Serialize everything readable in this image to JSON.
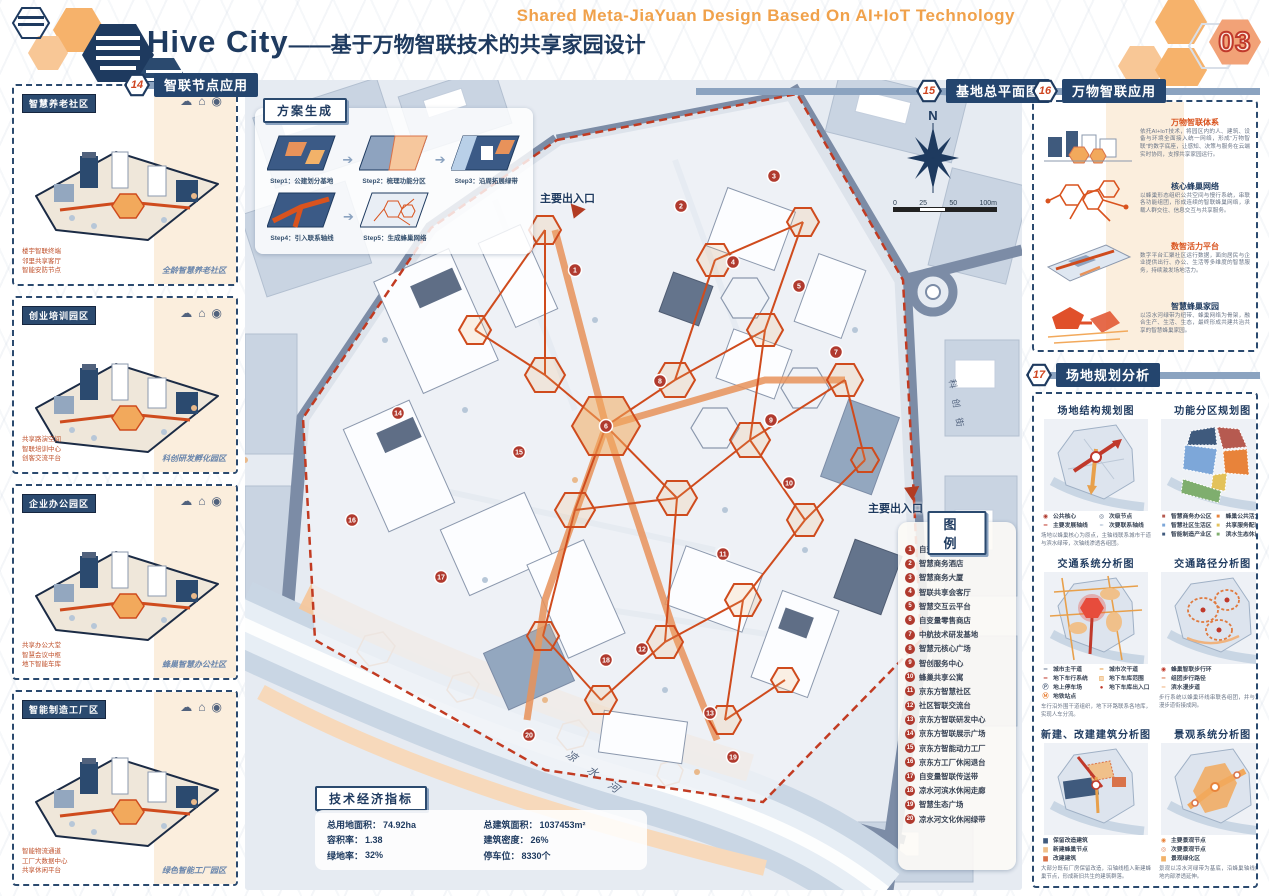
{
  "page": {
    "number": "03"
  },
  "colors": {
    "navy": "#1e3a5f",
    "orange": "#f0a14b",
    "accent_red": "#cf4520",
    "peach": "#f2a277",
    "panel_cream": "#fbeedd"
  },
  "header": {
    "subtitle_en": "Shared Meta-JiaYuan Design Based On AI+IoT Technology",
    "title_en": "· Hive City",
    "title_cn": "——基于万物智联技术的共享家园设计"
  },
  "sections": {
    "s14": {
      "tag": "14",
      "title": "智联节点应用"
    },
    "s15": {
      "tag": "15",
      "title": "基地总平面图"
    },
    "s16": {
      "tag": "16",
      "title": "万物智联应用"
    },
    "s17": {
      "tag": "17",
      "title": "场地规划分析"
    }
  },
  "left_panels": [
    {
      "label": "智慧养老社区",
      "caption": "全龄智慧养老社区",
      "callouts": [
        "楼宇智联终端",
        "邻里共享客厅",
        "智能安防节点"
      ]
    },
    {
      "label": "创业培训园区",
      "caption": "科创研发孵化园区",
      "callouts": [
        "共享路演空间",
        "智联培训中心",
        "创客交流平台"
      ]
    },
    {
      "label": "企业办公园区",
      "caption": "蜂巢智慧办公社区",
      "callouts": [
        "共享办公大堂",
        "智慧会议中枢",
        "地下智能车库"
      ]
    },
    {
      "label": "智能制造工厂区",
      "caption": "绿色智能工厂园区",
      "callouts": [
        "智能物流通道",
        "工厂大数据中心",
        "共享休闲平台"
      ]
    }
  ],
  "scheme": {
    "title": "方案生成",
    "steps": [
      "Step1：公建划分基地",
      "Step2：梳理功能分区",
      "Step3：沿周拓展绿带",
      "Step4：引入联系轴线",
      "Step5：生成蜂巢网络"
    ]
  },
  "map": {
    "north": "N",
    "scale_ticks": [
      "0",
      "25",
      "50",
      "100m"
    ],
    "entrance_top": "主要出入口",
    "entrance_right": "主要出入口",
    "river": "凉 水 河",
    "road": "科 创 街"
  },
  "legend": {
    "title": "图例",
    "items": [
      {
        "n": "1",
        "label": "自变量研发基地"
      },
      {
        "n": "2",
        "label": "智慧商务酒店"
      },
      {
        "n": "3",
        "label": "智慧商务大厦"
      },
      {
        "n": "4",
        "label": "智联共享会客厅"
      },
      {
        "n": "5",
        "label": "智慧交互云平台"
      },
      {
        "n": "6",
        "label": "自变量零售商店"
      },
      {
        "n": "7",
        "label": "中航技术研发基地"
      },
      {
        "n": "8",
        "label": "智慧元核心广场"
      },
      {
        "n": "9",
        "label": "智创服务中心"
      },
      {
        "n": "10",
        "label": "蜂巢共享公寓"
      },
      {
        "n": "11",
        "label": "京东方智慧社区"
      },
      {
        "n": "12",
        "label": "社区智联交流台"
      },
      {
        "n": "13",
        "label": "京东方智联研发中心"
      },
      {
        "n": "14",
        "label": "京东方智联展示广场"
      },
      {
        "n": "15",
        "label": "京东方智能动力工厂"
      },
      {
        "n": "16",
        "label": "京东方工厂休闲退台"
      },
      {
        "n": "17",
        "label": "自变量智联传送带"
      },
      {
        "n": "18",
        "label": "凉水河滨水休闲走廊"
      },
      {
        "n": "19",
        "label": "智慧生态广场"
      },
      {
        "n": "20",
        "label": "凉水河文化休闲绿带"
      }
    ]
  },
  "indicators": {
    "title": "技术经济指标",
    "rows": [
      {
        "label": "总用地面积：",
        "value": "74.92ha"
      },
      {
        "label": "容积率：",
        "value": "1.38"
      },
      {
        "label": "绿地率：",
        "value": "32%"
      },
      {
        "label": "总建筑面积：",
        "value": "1037453m²"
      },
      {
        "label": "建筑密度：",
        "value": "26%"
      },
      {
        "label": "停车位：",
        "value": "8330个"
      }
    ]
  },
  "iot": {
    "blocks": [
      {
        "title": "万物智联体系",
        "text": "依托AI+IoT技术，将园区内的人、建筑、设备与环境全面接入统一网络，形成“万物智联”的数字底座，让感知、决策与服务在云端实时协同，支撑共享家园运行。"
      },
      {
        "title": "核心蜂巢网络",
        "text": "以蜂巢形态组织公共空间与慢行系统，串联各功能组团，形成连续的智联蜂巢网络，承载人群交往、信息交互与共享服务。"
      },
      {
        "title": "数智活力平台",
        "text": "数字平台汇聚社区运行数据，面向居民与企业提供出行、办公、生活等多维度的智慧服务，持续激发场地活力。"
      },
      {
        "title": "智慧蜂巢家园",
        "text": "以凉水河绿带为纽带、蜂巢网络为骨架，融合生产、生活、生态，最终形成共建共治共享的智慧蜂巢家园。"
      }
    ]
  },
  "analysis": {
    "maps": [
      {
        "title": "场地结构规划图",
        "legend": [
          {
            "s": "◉",
            "c": "#b03a2e",
            "label": "公共核心"
          },
          {
            "s": "◎",
            "c": "#51627d",
            "label": "次级节点"
          },
          {
            "s": "━",
            "c": "#c0392b",
            "label": "主要发展轴线"
          },
          {
            "s": "┅",
            "c": "#8ba3c0",
            "label": "次要联系轴线"
          }
        ],
        "note": "场地以蜂巢核心为原点，主轴线联系城市干道与滨水绿带，次轴线渗透各组团。"
      },
      {
        "title": "功能分区规划图",
        "legend": [
          {
            "s": "■",
            "c": "#b65a50",
            "label": "智慧商务办公区"
          },
          {
            "s": "■",
            "c": "#e8833a",
            "label": "蜂巢公共活力区"
          },
          {
            "s": "■",
            "c": "#7da7d9",
            "label": "智慧社区生活区"
          },
          {
            "s": "■",
            "c": "#e3c25a",
            "label": "共享服务配套区"
          },
          {
            "s": "■",
            "c": "#3f5a7d",
            "label": "智能制造产业区"
          },
          {
            "s": "■",
            "c": "#7fae6e",
            "label": "滨水生态休闲区"
          }
        ],
        "note": ""
      },
      {
        "title": "交通系统分析图",
        "legend": [
          {
            "s": "━",
            "c": "#6b7b94",
            "label": "城市主干道"
          },
          {
            "s": "━",
            "c": "#e8a04b",
            "label": "城市次干道"
          },
          {
            "s": "━",
            "c": "#c0392b",
            "label": "地下车行系统"
          },
          {
            "s": "▧",
            "c": "#e8a04b",
            "label": "地下车库范围"
          },
          {
            "s": "Ⓟ",
            "c": "#51627d",
            "label": "地上停车场"
          },
          {
            "s": "●",
            "c": "#c0392b",
            "label": "地下车库出入口"
          },
          {
            "s": "Ⓜ",
            "c": "#e8833a",
            "label": "地铁站点"
          }
        ],
        "note": "车行沿外围干道组织，地下环路联系各地库，实现人车分流。"
      },
      {
        "title": "交通路径分析图",
        "legend": [
          {
            "s": "◉",
            "c": "#c0392b",
            "label": "蜂巢智联步行环"
          },
          {
            "s": "━",
            "c": "#d9734a",
            "label": "组团步行路径"
          },
          {
            "s": "━",
            "c": "#f0b37e",
            "label": "滨水漫步道"
          }
        ],
        "note": "步行系统以蜂巢环线串联各组团，并与滨水漫步道衔接成网。"
      },
      {
        "title": "新建、改建建筑分析图",
        "legend": [
          {
            "s": "▆",
            "c": "#3f5a7d",
            "label": "保留改造建筑"
          },
          {
            "s": "▆",
            "c": "#f0c08a",
            "label": "新建蜂巢节点"
          },
          {
            "s": "▆",
            "c": "#d9734a",
            "label": "改建建筑"
          }
        ],
        "note": "大部分既有厂房保留改造，沿轴线植入新建蜂巢节点，形成新旧共生的建筑群落。"
      },
      {
        "title": "景观系统分析图",
        "legend": [
          {
            "s": "◉",
            "c": "#e8833a",
            "label": "主要景观节点"
          },
          {
            "s": "◎",
            "c": "#d9734a",
            "label": "次要景观节点"
          },
          {
            "s": "▆",
            "c": "#f2b269",
            "label": "景观绿化区"
          }
        ],
        "note": "景观以凉水河绿带为基底，沿蜂巢轴线向场地内部渗透延伸。"
      }
    ]
  }
}
